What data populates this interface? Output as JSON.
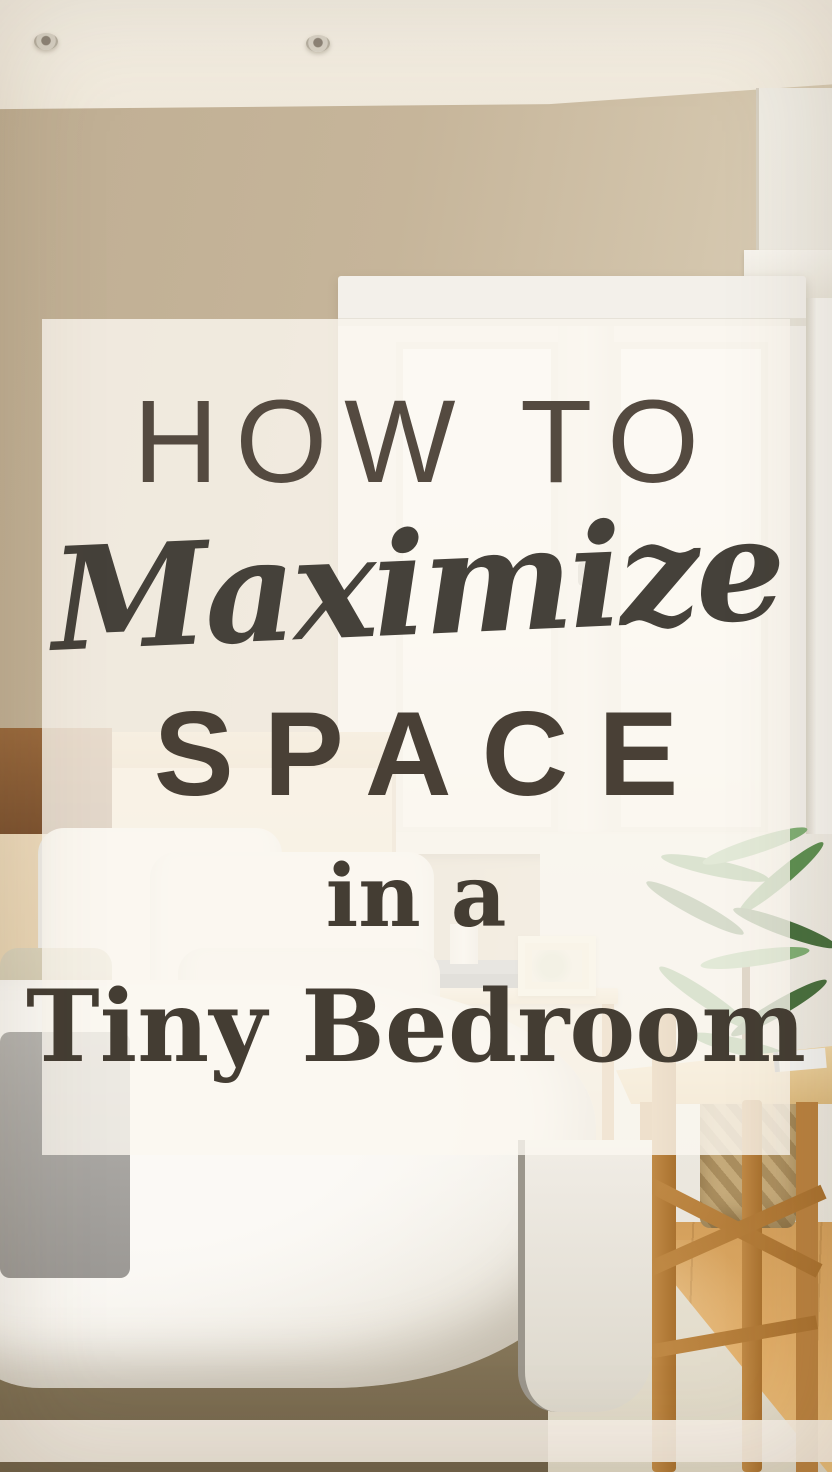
{
  "title": {
    "lines": [
      {
        "text": "HOW TO",
        "font": "rounded-sans"
      },
      {
        "text": "Maximize",
        "font": "brush-script"
      },
      {
        "text": "SPACE",
        "font": "rounded-sans"
      },
      {
        "text": "in a",
        "font": "serif"
      },
      {
        "text": "Tiny Bedroom",
        "font": "serif-bold"
      }
    ]
  },
  "scene_objects": [
    "ceiling with two recessed lights",
    "beige wall",
    "white framed double window",
    "light-wood headboard with dark bed post",
    "white pillows and beige accent pillow",
    "white duvet and gray throw blanket",
    "wooden nightstand with drawer and three knobs",
    "white mushroom table lamp on book stack",
    "cream picture frame",
    "potted green plant in woven basket",
    "wooden desk with notebook",
    "wooden chair with cross braces",
    "warm wood plank floor",
    "cream runner rug"
  ],
  "colors": {
    "wall": "#bfae93",
    "ceiling": "#efe8da",
    "window_trim": "#f3f0ea",
    "headboard": "#eedcbf",
    "duvet": "#f6f3ed",
    "blanket": "#9c9995",
    "nightstand_wood": "#b5854e",
    "floor": "#dfab66",
    "rug": "#e8e2d3",
    "plant_green": "#5d8f52",
    "text": "#4a4238",
    "panel": "rgba(251,247,240,0.8)",
    "bottom_bar": "rgba(246,240,231,0.9)"
  }
}
